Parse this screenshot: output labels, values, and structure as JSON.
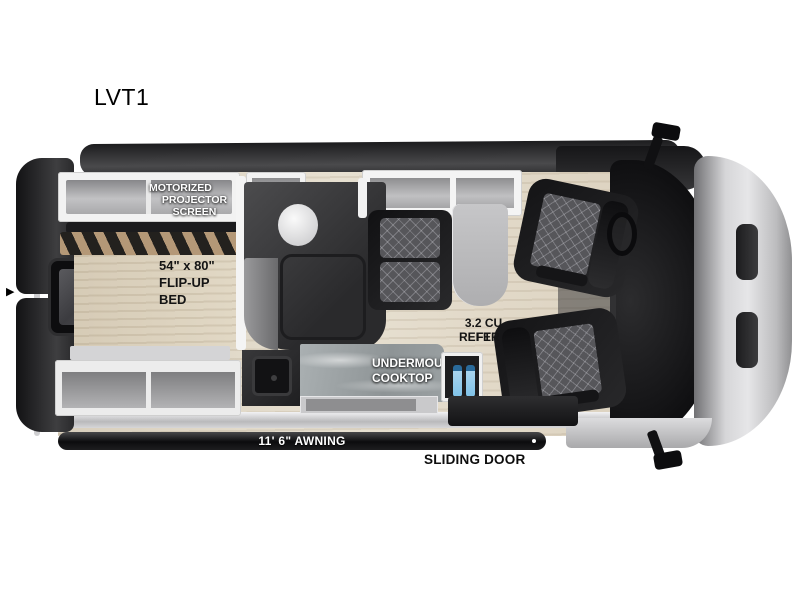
{
  "title": "LVT1",
  "icons": {
    "entry_arrow": "▶"
  },
  "labels": {
    "projector_screen": {
      "line1": "MOTORIZED",
      "line2": "PROJECTOR SCREEN"
    },
    "flip_up_bed": {
      "line1": "54\" x 80\"",
      "line2": "FLIP-UP",
      "line3": "BED"
    },
    "refer": {
      "line1": "3.2 CU FT",
      "line2": "REFER"
    },
    "cooktop": {
      "line1": "UNDERMOUNT",
      "line2": "COOKTOP"
    },
    "awning": "11' 6\" AWNING",
    "sliding_door": "SLIDING DOOR"
  },
  "colors": {
    "background": "#ffffff",
    "body_dark": "#2b2b2d",
    "hood_silver": "#c9c9cb",
    "floor_wood": "#ded5c5",
    "cabinet_frame": "#f2f2f2",
    "cabinet_door": "#a9a9ab",
    "counter_marble": "#9aa0a2",
    "shower_teak": "#8d7154",
    "bed_slat_tan": "#b49877",
    "seat_black": "#1b1b1d",
    "seat_quilt_gray": "#56565a",
    "bottle_blue": "#7fc2e8",
    "label_dark": "#141414",
    "label_light": "#ffffff"
  }
}
